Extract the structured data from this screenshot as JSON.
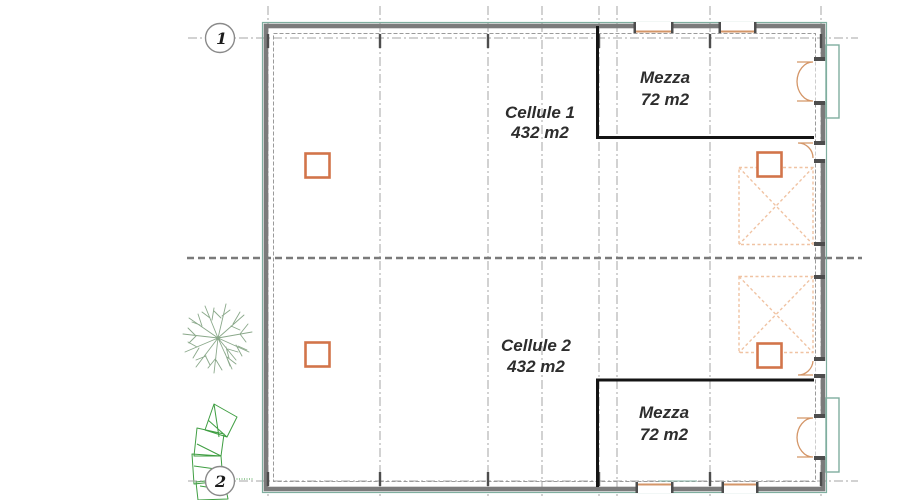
{
  "grid_markers": {
    "marker1": "1",
    "marker2": "2"
  },
  "rooms": {
    "cellule1": {
      "name": "Cellule 1",
      "area": "432 m2"
    },
    "mezza1": {
      "name": "Mezza",
      "area": "72 m2"
    },
    "cellule2": {
      "name": "Cellule 2",
      "area": "432 m2"
    },
    "mezza2": {
      "name": "Mezza",
      "area": "72 m2"
    }
  },
  "icons": {
    "column_marker": "structural-column-icon",
    "zone_marker": "cross-reserved-zone-icon",
    "door_marker": "door-swing-icon",
    "tree_round": "deciduous-tree-icon",
    "tree_faceted": "conifer-tree-icon"
  },
  "colors": {
    "grid-gray": "#a4a4a4",
    "mid-gray": "#7a7a7a",
    "tick-dark": "#4d4d4d",
    "wall-gray": "#7b7b7b",
    "wall-teal": "#7fae9f",
    "mezz-black": "#141414",
    "column-orange": "#d2744a",
    "zone-peach": "#f0c3a3",
    "door-tan": "#d49668",
    "tree-green": "#3f9e42",
    "tree-gray-green": "#8aa88a"
  }
}
